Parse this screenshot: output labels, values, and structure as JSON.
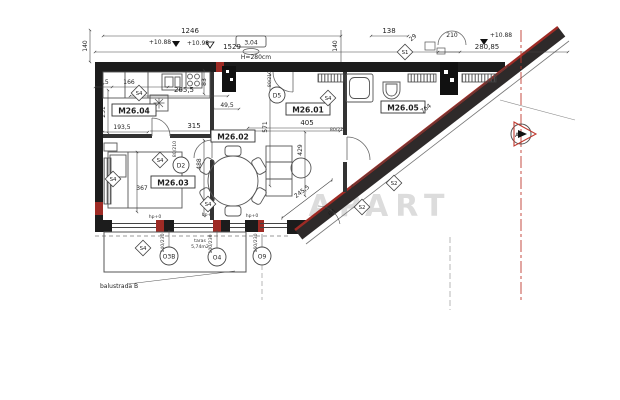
{
  "plan": {
    "watermark": "APART",
    "rooms": {
      "r01": "M26.01",
      "r02": "M26.02",
      "r03": "M26.03",
      "r04": "M26.04",
      "r05": "M26.05"
    },
    "dims": {
      "d1246": "1246",
      "d1529": "1529",
      "d140": "140",
      "d138": "138",
      "d29": "29",
      "d210": "210",
      "d28085": "280,85",
      "d304": "3,04",
      "h280": "H=280cm",
      "d275": "27,5",
      "d166": "166",
      "d231": "231",
      "d1935": "193,5",
      "d367": "367",
      "d2655": "265,5",
      "d495": "49,5",
      "d83": "83",
      "d315": "315",
      "d488": "488",
      "d571": "571",
      "d405": "405",
      "d429": "429",
      "d764": "764",
      "d2455": "245,5",
      "d64": "64"
    },
    "levels": {
      "l1": "+10.88",
      "l2": "+10.98",
      "l3": "+10.88"
    },
    "markers": {
      "s1": "S1",
      "s2": "S2",
      "s4": "S4"
    },
    "doors": {
      "d2": "D2",
      "d5": "D5"
    },
    "door_size": "80/210",
    "windows": {
      "o3b": "O3B",
      "o4": "O4",
      "o9": "O9"
    },
    "window_sizes": {
      "o3b": "140/230",
      "o4": "100/230",
      "o9": "160/230"
    },
    "balcony": {
      "label": "balustrada B",
      "name": "taras",
      "area": "5,74m2",
      "hp": "hp+0"
    },
    "section": {
      "letter": "A"
    },
    "colors": {
      "wall": "#1c1c1c",
      "accent_red": "#9e2b25",
      "section_red": "#c03a30"
    }
  }
}
